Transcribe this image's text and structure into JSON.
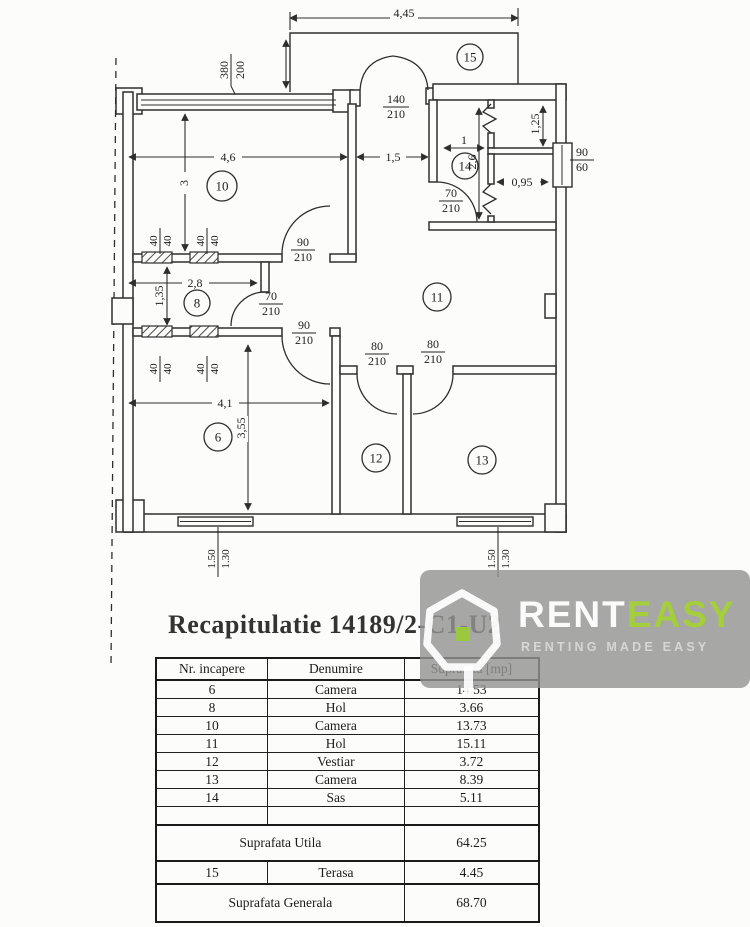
{
  "title": "Recapitulatie 14189/2-C1-U2",
  "logo": {
    "brand_rent": "RENT",
    "brand_easy": "EASY",
    "tagline": "RENTING MADE EASY"
  },
  "colors": {
    "accent_green": "#a4ce3b",
    "watermark_gray": "#949494",
    "line": "#2e2e2e"
  },
  "plan": {
    "rooms": {
      "r6": "6",
      "r8": "8",
      "r10": "10",
      "r11": "11",
      "r12": "12",
      "r13": "13",
      "r14": "14",
      "r15": "15"
    },
    "dims": {
      "terrace_width": "4,45",
      "room10_width": "4,6",
      "hall_width": "1,5",
      "room10_depth": "3",
      "room8_width": "2,8",
      "room8_depth": "1,35",
      "room6_width": "4,1",
      "room6_depth": "3,55",
      "room14_width": "1",
      "room14_depth": "2,6",
      "closet_depth": "1,25",
      "niche_width": "0,95",
      "column": "40"
    },
    "openings": {
      "top_window": {
        "w": "380",
        "h": "200"
      },
      "terrace_door": {
        "w": "140",
        "h": "210"
      },
      "right_window": {
        "w": "90",
        "h": "60"
      },
      "door_90": {
        "w": "90",
        "h": "210"
      },
      "door_70": {
        "w": "70",
        "h": "210"
      },
      "door_80": {
        "w": "80",
        "h": "210"
      },
      "bottom_window": {
        "w": "1.50",
        "h": "1.30"
      }
    }
  },
  "table": {
    "headers": [
      "Nr. incapere",
      "Denumire",
      "Suprafata [mp]"
    ],
    "rows": [
      {
        "nr": "6",
        "name": "Camera",
        "area": "14.53"
      },
      {
        "nr": "8",
        "name": "Hol",
        "area": "3.66"
      },
      {
        "nr": "10",
        "name": "Camera",
        "area": "13.73"
      },
      {
        "nr": "11",
        "name": "Hol",
        "area": "15.11"
      },
      {
        "nr": "12",
        "name": "Vestiar",
        "area": "3.72"
      },
      {
        "nr": "13",
        "name": "Camera",
        "area": "8.39"
      },
      {
        "nr": "14",
        "name": "Sas",
        "area": "5.11"
      }
    ],
    "totals": {
      "utila_label": "Suprafata Utila",
      "utila_value": "64.25",
      "terasa_nr": "15",
      "terasa_name": "Terasa",
      "terasa_value": "4.45",
      "generala_label": "Suprafata Generala",
      "generala_value": "68.70"
    }
  }
}
